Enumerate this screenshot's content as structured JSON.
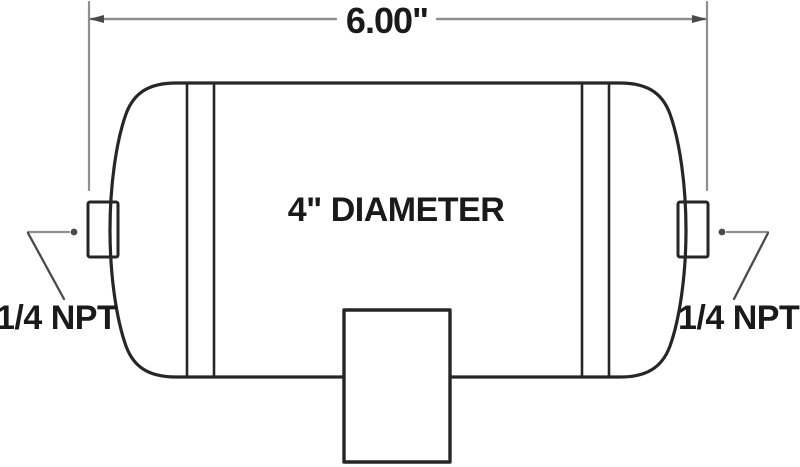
{
  "diagram": {
    "type": "technical-drawing",
    "subject": "cylindrical air tank, side elevation view",
    "labels": {
      "length_dimension": "6.00\"",
      "diameter": "4\" DIAMETER",
      "left_port": "1/4 NPT",
      "right_port": "1/4 NPT"
    },
    "colors": {
      "background": "#ffffff",
      "outline": "#262626",
      "dimension_line": "#8f8f8f",
      "leader_line": "#4a4a4a",
      "text": "#1a1a1a"
    }
  }
}
